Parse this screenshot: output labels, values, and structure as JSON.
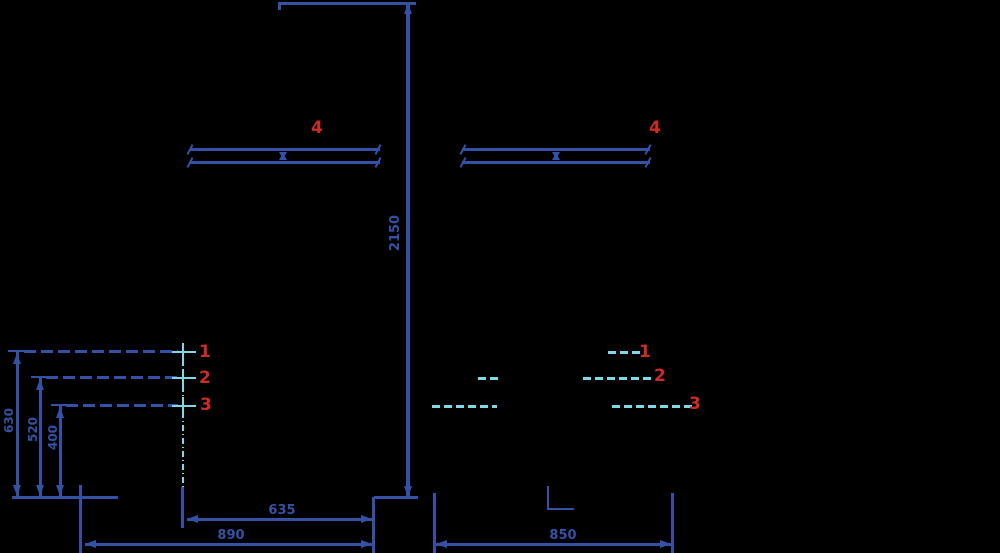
{
  "colors": {
    "line_blue": "#3352a5",
    "accent_cyan": "#7fd8e6",
    "label_red": "#cd2b26",
    "background": "#000000"
  },
  "dimensions": {
    "total_height": "2150",
    "height_item1": "630",
    "height_item2": "520",
    "height_item3": "400",
    "width_bottom_left": "890",
    "width_bottom_center": "635",
    "width_bottom_right": "850"
  },
  "callouts": {
    "left": [
      "1",
      "2",
      "3"
    ],
    "right": [
      "1",
      "2",
      "3"
    ],
    "rod_left": "4",
    "rod_right": "4"
  }
}
